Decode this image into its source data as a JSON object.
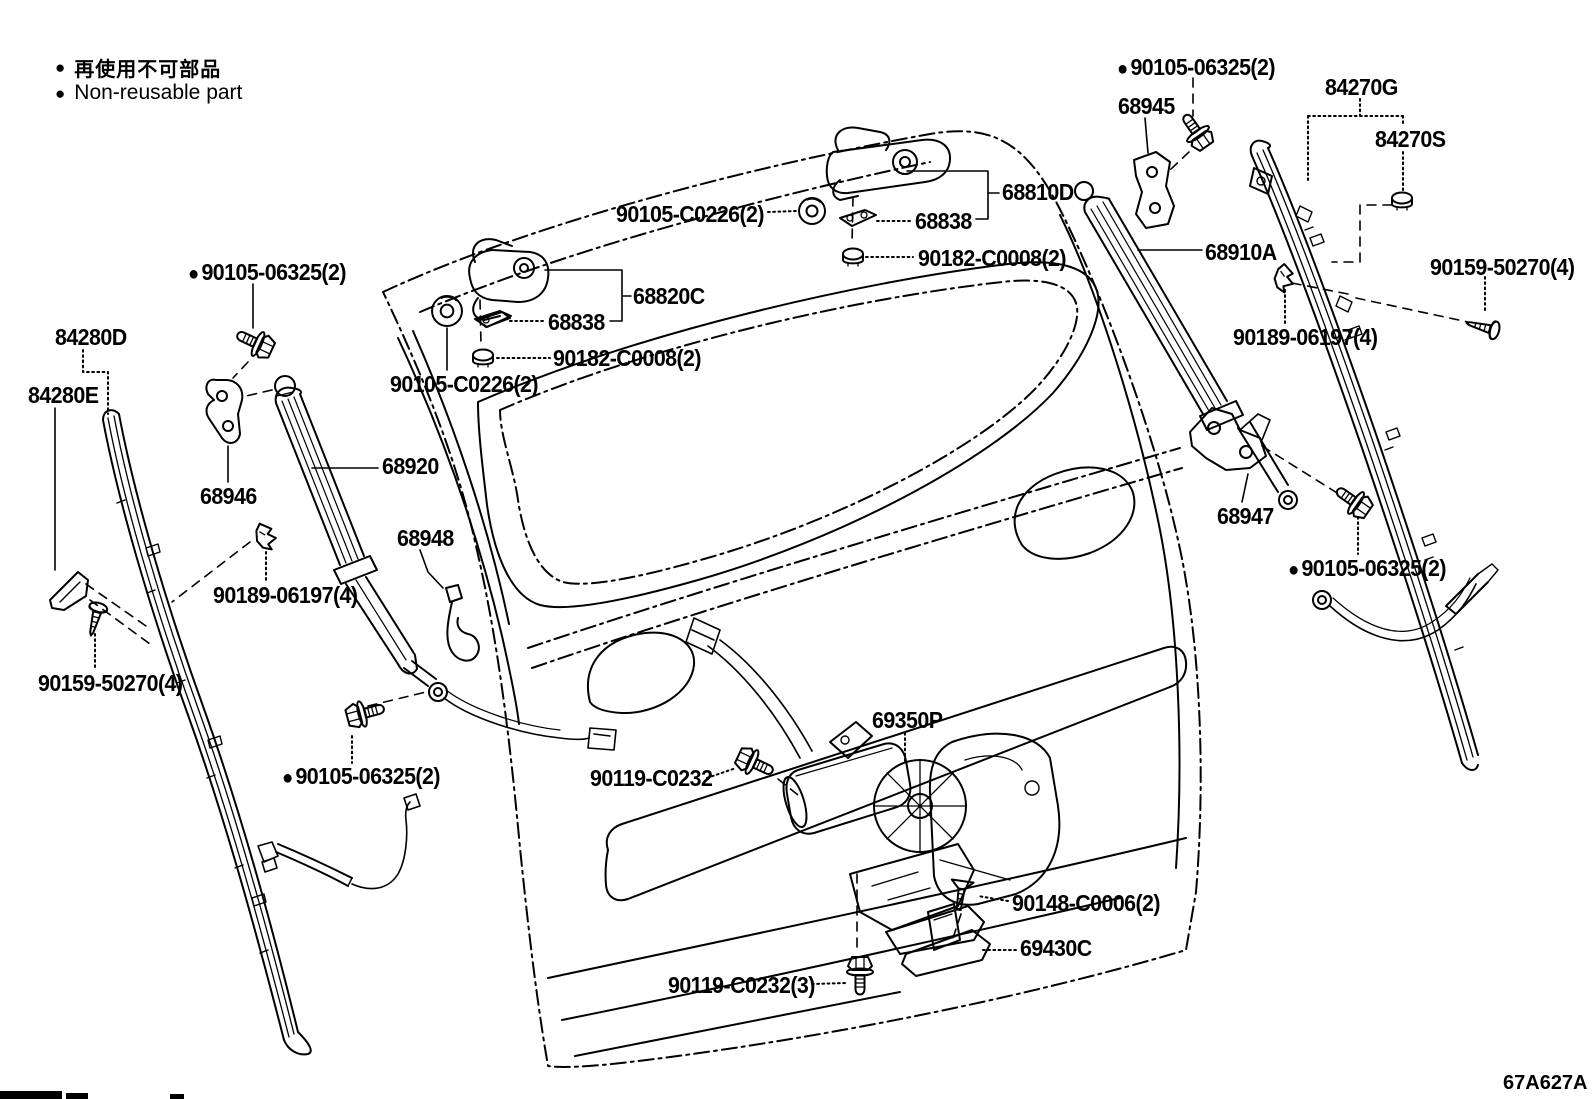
{
  "legend": {
    "bullet": "●",
    "jp": "再使用不可部品",
    "en": "Non-reusable part"
  },
  "diagram_code": "67A627A",
  "colors": {
    "line": "#000000",
    "background": "#ffffff"
  },
  "labels": [
    {
      "id": "90105-06325-top-right",
      "text": "90105-06325(2)",
      "x": 1117,
      "y": 56,
      "bullet": true
    },
    {
      "id": "68945",
      "text": "68945",
      "x": 1118,
      "y": 95,
      "bullet": false
    },
    {
      "id": "84270G",
      "text": "84270G",
      "x": 1325,
      "y": 76,
      "bullet": false
    },
    {
      "id": "84270S",
      "text": "84270S",
      "x": 1375,
      "y": 128,
      "bullet": false
    },
    {
      "id": "68810D",
      "text": "68810D",
      "x": 1002,
      "y": 181,
      "bullet": false
    },
    {
      "id": "90105-C0226-right",
      "text": "90105-C0226(2)",
      "x": 616,
      "y": 203,
      "bullet": false
    },
    {
      "id": "68838-right",
      "text": "68838",
      "x": 915,
      "y": 210,
      "bullet": false
    },
    {
      "id": "90182-C0008-right",
      "text": "90182-C0008(2)",
      "x": 918,
      "y": 247,
      "bullet": false
    },
    {
      "id": "68820C",
      "text": "68820C",
      "x": 633,
      "y": 285,
      "bullet": false
    },
    {
      "id": "68838-left",
      "text": "68838",
      "x": 548,
      "y": 311,
      "bullet": false
    },
    {
      "id": "90182-C0008-left",
      "text": "90182-C0008(2)",
      "x": 553,
      "y": 347,
      "bullet": false
    },
    {
      "id": "90105-C0226-left",
      "text": "90105-C0226(2)",
      "x": 390,
      "y": 373,
      "bullet": false
    },
    {
      "id": "90105-06325-left",
      "text": "90105-06325(2)",
      "x": 188,
      "y": 261,
      "bullet": true
    },
    {
      "id": "84280D",
      "text": "84280D",
      "x": 55,
      "y": 326,
      "bullet": false
    },
    {
      "id": "84280E",
      "text": "84280E",
      "x": 28,
      "y": 384,
      "bullet": false
    },
    {
      "id": "68946",
      "text": "68946",
      "x": 200,
      "y": 485,
      "bullet": false
    },
    {
      "id": "68920",
      "text": "68920",
      "x": 382,
      "y": 455,
      "bullet": false
    },
    {
      "id": "68948",
      "text": "68948",
      "x": 397,
      "y": 527,
      "bullet": false
    },
    {
      "id": "90189-06197-left",
      "text": "90189-06197(4)",
      "x": 213,
      "y": 584,
      "bullet": false
    },
    {
      "id": "90159-50270-left",
      "text": "90159-50270(4)",
      "x": 38,
      "y": 672,
      "bullet": false
    },
    {
      "id": "90105-06325-bottom-left",
      "text": "90105-06325(2)",
      "x": 282,
      "y": 765,
      "bullet": true
    },
    {
      "id": "90119-C0232",
      "text": "90119-C0232",
      "x": 590,
      "y": 767,
      "bullet": false
    },
    {
      "id": "69350P",
      "text": "69350P",
      "x": 872,
      "y": 709,
      "bullet": false
    },
    {
      "id": "90148-C0006",
      "text": "90148-C0006(2)",
      "x": 1012,
      "y": 892,
      "bullet": false
    },
    {
      "id": "69430C",
      "text": "69430C",
      "x": 1020,
      "y": 937,
      "bullet": false
    },
    {
      "id": "90119-C0232-3",
      "text": "90119-C0232(3)",
      "x": 668,
      "y": 974,
      "bullet": false
    },
    {
      "id": "68910A",
      "text": "68910A",
      "x": 1205,
      "y": 241,
      "bullet": false
    },
    {
      "id": "90159-50270-right",
      "text": "90159-50270(4)",
      "x": 1430,
      "y": 256,
      "bullet": false
    },
    {
      "id": "90189-06197-right",
      "text": "90189-06197(4)",
      "x": 1233,
      "y": 326,
      "bullet": false
    },
    {
      "id": "68947",
      "text": "68947",
      "x": 1217,
      "y": 505,
      "bullet": false
    },
    {
      "id": "90105-06325-right",
      "text": "90105-06325(2)",
      "x": 1288,
      "y": 557,
      "bullet": true
    }
  ]
}
